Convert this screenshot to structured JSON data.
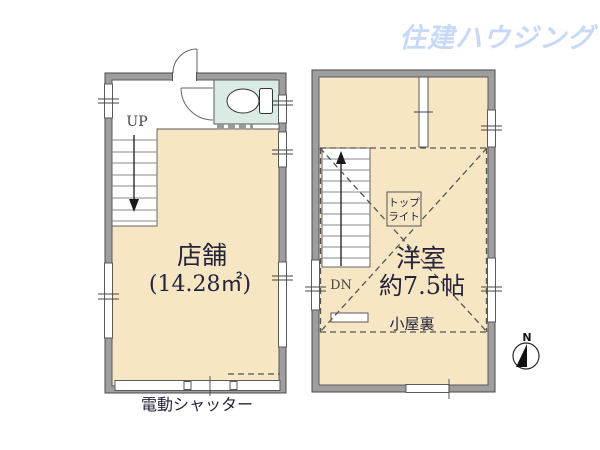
{
  "logo": {
    "text": "住建ハウジング"
  },
  "left_plan": {
    "up_label": "UP",
    "room_name": "店舗",
    "room_area": "(14.28㎡)",
    "caption": "電動シャッター"
  },
  "right_plan": {
    "dn_label": "DN",
    "room_name": "洋室",
    "room_size": "約7.5帖",
    "attic_label": "小屋裏",
    "skylight": {
      "line1": "トップ",
      "line2": "ライト"
    }
  },
  "compass": {
    "north_label": "N"
  },
  "colors": {
    "room_fill": "#F6E6C3",
    "toilet_fill": "#D9EBE3",
    "wall_fill": "#9E9E9E",
    "wall_stroke": "#4a4a4a",
    "text_color": "#23233a",
    "logo_color": "#C8D9F7"
  }
}
